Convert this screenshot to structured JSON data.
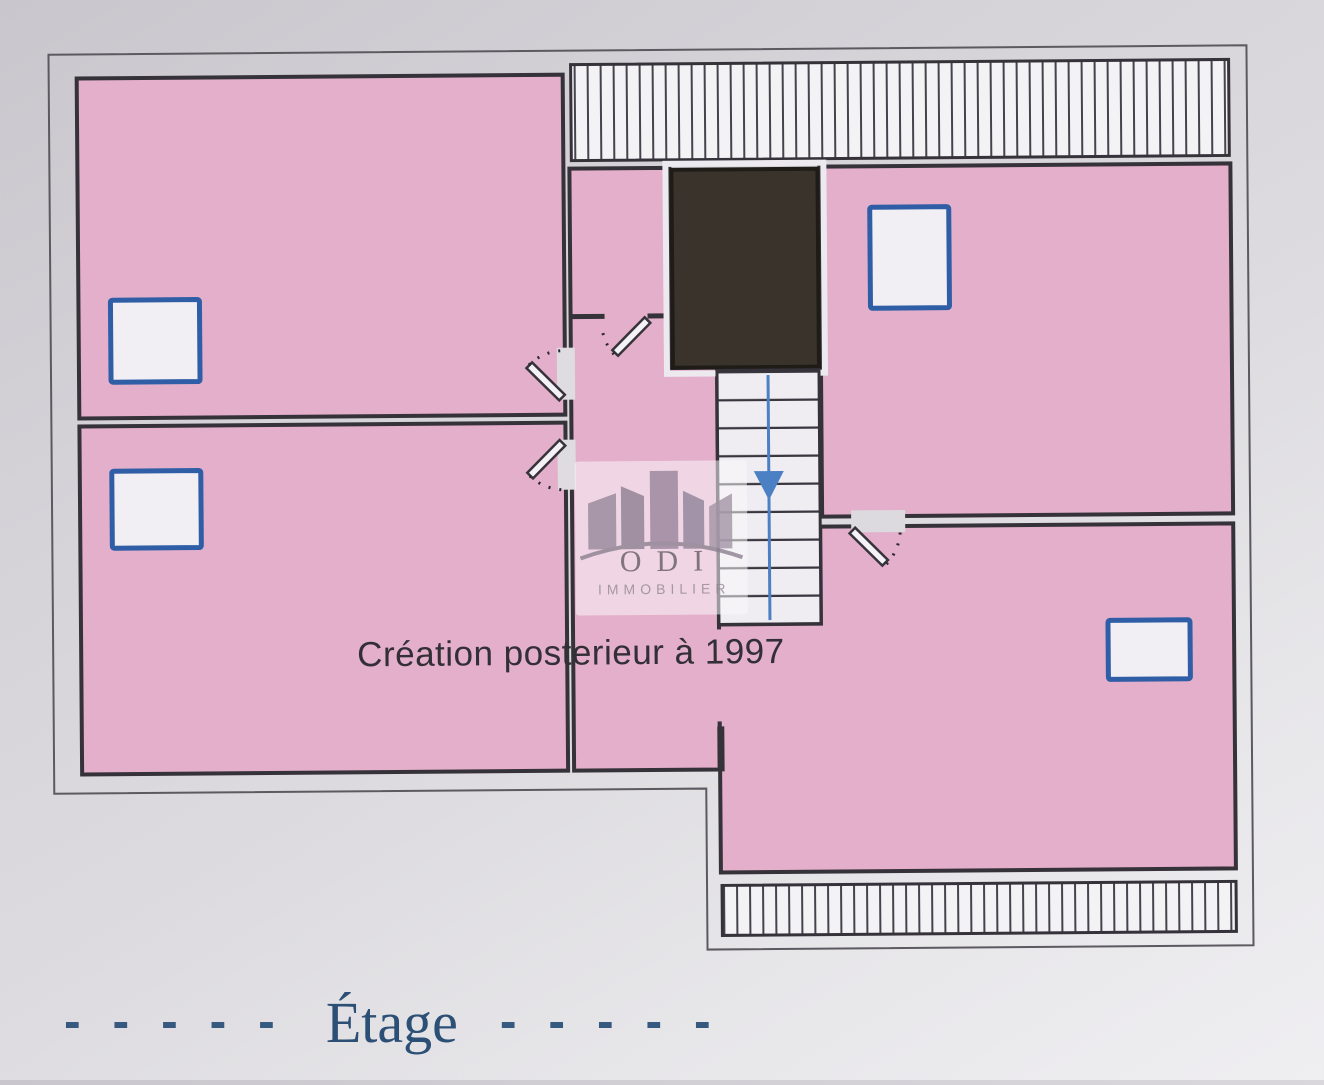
{
  "plan": {
    "annotation": "Création posterieur à 1997",
    "floor_label": {
      "dashes_left": "- - - - -",
      "title": "Étage",
      "dashes_right": "- - - - -"
    },
    "watermark": {
      "name": "ODI",
      "subtitle": "IMMOBILIER"
    },
    "stairs": {
      "steps": 9,
      "direction_icon": "down-arrow"
    },
    "colors": {
      "room_fill": "#e3afcb",
      "wall": "#35323a",
      "window_frame": "#2f5ea6",
      "window_fill": "#f1eff3",
      "stair_arrow": "#4b80c4",
      "void_fill": "#3a332b",
      "hatch_fill": "#f3f2f5",
      "paper_gap": "#dedce0",
      "outer_boundary": "#5c5960",
      "floor_label_color": "#2e5278"
    }
  }
}
